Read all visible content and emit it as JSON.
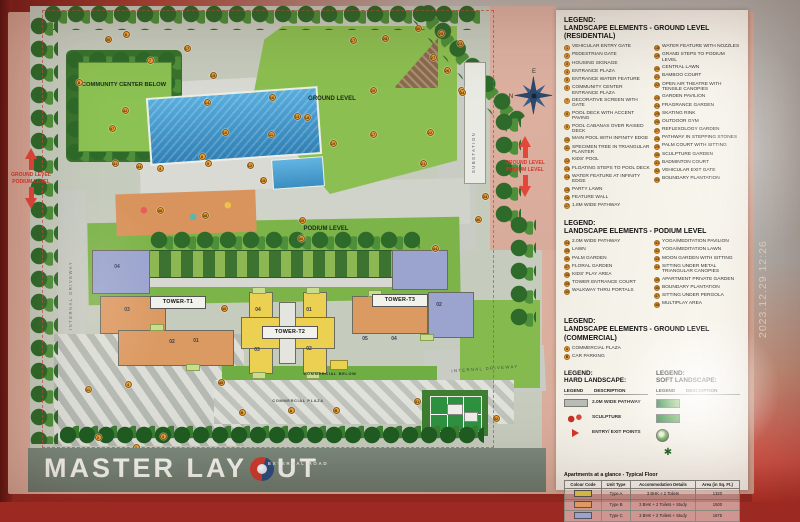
{
  "photo": {
    "timestamp": "2023.12.29 12:26"
  },
  "band": {
    "part1": "MASTER LAY",
    "part2": "UT",
    "full_title": "MASTER LAYOUT"
  },
  "map": {
    "labels": {
      "community_center": "COMMUNITY CENTER BELOW",
      "ground_level": "GROUND LEVEL",
      "podium_level": "PODIUM LEVEL",
      "commercial_below": "COMMERCIAL BELOW",
      "commercial_plaza": "COMMERCIAL PLAZA",
      "internal_driveway_left": "INTERNAL DRIVEWAY",
      "internal_driveway_right": "INTERNAL DRIVEWAY",
      "substation": "SUBSTATION",
      "external_road": "EXTERNAL ROAD"
    },
    "towers": [
      {
        "label": "TOWER-T1"
      },
      {
        "label": "TOWER-T2"
      },
      {
        "label": "TOWER-T3"
      }
    ],
    "level_indicator": {
      "line1": "GROUND LEVEL",
      "line2": "PODIUM LEVEL"
    },
    "compass": {
      "top": "E",
      "right": "S",
      "bottom": "W",
      "left": "N"
    },
    "unit_labels": [
      {
        "t": "04",
        "x": 117,
        "y": 268
      },
      {
        "t": "03",
        "x": 127,
        "y": 311
      },
      {
        "t": "02",
        "x": 172,
        "y": 343
      },
      {
        "t": "01",
        "x": 196,
        "y": 342
      },
      {
        "t": "04",
        "x": 258,
        "y": 311
      },
      {
        "t": "01",
        "x": 309,
        "y": 311
      },
      {
        "t": "03",
        "x": 257,
        "y": 351
      },
      {
        "t": "02",
        "x": 309,
        "y": 350
      },
      {
        "t": "05",
        "x": 365,
        "y": 340
      },
      {
        "t": "04",
        "x": 394,
        "y": 340
      },
      {
        "t": "02",
        "x": 439,
        "y": 306
      }
    ],
    "markers": [
      {
        "n": "1",
        "x": 136,
        "y": 447
      },
      {
        "n": "2",
        "x": 98,
        "y": 437
      },
      {
        "n": "3",
        "x": 163,
        "y": 436
      },
      {
        "n": "4",
        "x": 128,
        "y": 384
      },
      {
        "n": "4",
        "x": 160,
        "y": 168
      },
      {
        "n": "6",
        "x": 126,
        "y": 34
      },
      {
        "n": "7",
        "x": 150,
        "y": 60
      },
      {
        "n": "8",
        "x": 79,
        "y": 82
      },
      {
        "n": "8",
        "x": 202,
        "y": 156
      },
      {
        "n": "9",
        "x": 208,
        "y": 163
      },
      {
        "n": "10",
        "x": 225,
        "y": 132
      },
      {
        "n": "11",
        "x": 271,
        "y": 134
      },
      {
        "n": "11",
        "x": 88,
        "y": 389
      },
      {
        "n": "12",
        "x": 250,
        "y": 165
      },
      {
        "n": "13",
        "x": 297,
        "y": 116
      },
      {
        "n": "14",
        "x": 207,
        "y": 102
      },
      {
        "n": "15",
        "x": 213,
        "y": 75
      },
      {
        "n": "15",
        "x": 263,
        "y": 180
      },
      {
        "n": "16",
        "x": 272,
        "y": 97
      },
      {
        "n": "17",
        "x": 187,
        "y": 48
      },
      {
        "n": "17",
        "x": 353,
        "y": 40
      },
      {
        "n": "17",
        "x": 373,
        "y": 134
      },
      {
        "n": "18",
        "x": 307,
        "y": 117
      },
      {
        "n": "19",
        "x": 333,
        "y": 143
      },
      {
        "n": "20",
        "x": 373,
        "y": 90
      },
      {
        "n": "21",
        "x": 423,
        "y": 163
      },
      {
        "n": "22",
        "x": 430,
        "y": 132
      },
      {
        "n": "23",
        "x": 460,
        "y": 43
      },
      {
        "n": "24",
        "x": 461,
        "y": 90
      },
      {
        "n": "25",
        "x": 441,
        "y": 33
      },
      {
        "n": "26",
        "x": 447,
        "y": 70
      },
      {
        "n": "27",
        "x": 433,
        "y": 57
      },
      {
        "n": "28",
        "x": 385,
        "y": 38
      },
      {
        "n": "30",
        "x": 108,
        "y": 39
      },
      {
        "n": "30",
        "x": 418,
        "y": 28
      },
      {
        "n": "31",
        "x": 417,
        "y": 401
      },
      {
        "n": "32",
        "x": 496,
        "y": 418
      },
      {
        "n": "33",
        "x": 485,
        "y": 196
      },
      {
        "n": "34",
        "x": 462,
        "y": 92
      },
      {
        "n": "35",
        "x": 302,
        "y": 220
      },
      {
        "n": "36",
        "x": 301,
        "y": 238
      },
      {
        "n": "38",
        "x": 205,
        "y": 215
      },
      {
        "n": "40",
        "x": 224,
        "y": 308
      },
      {
        "n": "41",
        "x": 115,
        "y": 163
      },
      {
        "n": "42",
        "x": 125,
        "y": 110
      },
      {
        "n": "44",
        "x": 139,
        "y": 166
      },
      {
        "n": "44",
        "x": 435,
        "y": 248
      },
      {
        "n": "45",
        "x": 221,
        "y": 382
      },
      {
        "n": "46",
        "x": 478,
        "y": 219
      },
      {
        "n": "47",
        "x": 112,
        "y": 128
      },
      {
        "n": "48",
        "x": 160,
        "y": 210
      },
      {
        "n": "A",
        "x": 291,
        "y": 410
      },
      {
        "n": "B",
        "x": 242,
        "y": 412
      },
      {
        "n": "B",
        "x": 336,
        "y": 410
      }
    ]
  },
  "legend": {
    "residential": {
      "heading_label": "LEGEND:",
      "title": "LANDSCAPE ELEMENTS - GROUND LEVEL",
      "subtitle": "(RESIDENTIAL)",
      "items": [
        {
          "n": "1",
          "label": "VEHICULAR ENTRY GATE"
        },
        {
          "n": "2",
          "label": "PEDESTRIAN GATE"
        },
        {
          "n": "3",
          "label": "HOUSING SIGNAGE"
        },
        {
          "n": "4",
          "label": "ENTRANCE PLAZA"
        },
        {
          "n": "5",
          "label": "ENTRANCE WATER FEATURE"
        },
        {
          "n": "6",
          "label": "COMMUNITY CENTER ENTRANCE PLAZA"
        },
        {
          "n": "7",
          "label": "DECORATIVE SCREEN WITH GATE"
        },
        {
          "n": "8",
          "label": "POOL DECK WITH ACCENT PAVING"
        },
        {
          "n": "9",
          "label": "POOL CABANAS OVER RAISED DECK"
        },
        {
          "n": "10",
          "label": "MAIN POOL WITH INFINITY EDGE"
        },
        {
          "n": "11",
          "label": "SPECIMEN TREE IN TRIANGULAR PLANTER"
        },
        {
          "n": "12",
          "label": "KIDS' POOL"
        },
        {
          "n": "13",
          "label": "FLOATING STEPS TO POOL DECK"
        },
        {
          "n": "14",
          "label": "WATER FEATURE AT INFINITY EDGE"
        },
        {
          "n": "15",
          "label": "PARTY LAWN"
        },
        {
          "n": "16",
          "label": "FEATURE WALL"
        },
        {
          "n": "17",
          "label": "1.8M WIDE PATHWAY"
        },
        {
          "n": "18",
          "label": "WATER FEATURE WITH NOZZLES"
        },
        {
          "n": "19",
          "label": "GRAND STEPS TO PODIUM LEVEL"
        },
        {
          "n": "20",
          "label": "CENTRAL LAWN"
        },
        {
          "n": "21",
          "label": "BAMBOO COURT"
        },
        {
          "n": "22",
          "label": "OPEN AIR THEATRE WITH TENSILE CANOPIES"
        },
        {
          "n": "23",
          "label": "GARDEN PAVILION"
        },
        {
          "n": "24",
          "label": "FRAGRANCE GARDEN"
        },
        {
          "n": "25",
          "label": "SKATING RINK"
        },
        {
          "n": "26",
          "label": "OUTDOOR GYM"
        },
        {
          "n": "27",
          "label": "REFLEXOLOGY GARDEN"
        },
        {
          "n": "28",
          "label": "PATHWAY IN STEPPING STONES"
        },
        {
          "n": "29",
          "label": "PALM COURT WITH SITTING"
        },
        {
          "n": "30",
          "label": "SCULPTURE GARDEN"
        },
        {
          "n": "31",
          "label": "BADMINTON COURT"
        },
        {
          "n": "32",
          "label": "VEHICULAR EXIT GATE"
        },
        {
          "n": "33",
          "label": "BOUNDARY PLANTATION"
        }
      ]
    },
    "podium": {
      "heading_label": "LEGEND:",
      "title": "LANDSCAPE ELEMENTS - PODIUM LEVEL",
      "items": [
        {
          "n": "34",
          "label": "2.0M WIDE PATHWAY"
        },
        {
          "n": "35",
          "label": "LAWN"
        },
        {
          "n": "36",
          "label": "PALM GARDEN"
        },
        {
          "n": "37",
          "label": "FLORAL GARDEN"
        },
        {
          "n": "38",
          "label": "KIDS' PLAY AREA"
        },
        {
          "n": "39",
          "label": "TOWER ENTRANCE COURT"
        },
        {
          "n": "40",
          "label": "WALKWAY THRU PORTALS"
        },
        {
          "n": "41",
          "label": "YOGA/MEDITATION PAVILION"
        },
        {
          "n": "42",
          "label": "YOGA/MEDITATION LAWN"
        },
        {
          "n": "43",
          "label": "MOON GARDEN WITH SITTING"
        },
        {
          "n": "44",
          "label": "SITTING UNDER METAL TRIANGULAR CANOPIES"
        },
        {
          "n": "45",
          "label": "APARTMENT PRIVATE GARDEN"
        },
        {
          "n": "46",
          "label": "BOUNDARY PLANTATION"
        },
        {
          "n": "47",
          "label": "SITTING UNDER PERGOLA"
        },
        {
          "n": "48",
          "label": "MULTIPLAY AREA"
        }
      ]
    },
    "commercial": {
      "heading_label": "LEGEND:",
      "title": "LANDSCAPE ELEMENTS - GROUND LEVEL",
      "subtitle": "(COMMERCIAL)",
      "items": [
        {
          "n": "A",
          "label": "COMMERCIAL PLAZA"
        },
        {
          "n": "B",
          "label": "CAR PARKING"
        }
      ]
    },
    "hard": {
      "heading_label": "LEGEND:",
      "title": "HARD LANDSCAPE:",
      "col_legend": "LEGEND",
      "col_desc": "DESCRIPTION",
      "rows": [
        {
          "icon": "path-swatch",
          "label": "2.0M WIDE PATHWAY"
        },
        {
          "icon": "sculpture",
          "label": "SCULPTURE"
        },
        {
          "icon": "entry-arrow",
          "label": "ENTRY/ EXIT POINTS"
        }
      ]
    },
    "soft": {
      "heading_label": "LEGEND:",
      "title": "SOFT LANDSCAPE:",
      "col_legend": "LEGEND",
      "col_desc": "DESCRIPTION",
      "rows": [
        {
          "icon": "lawn-swatch",
          "label": ""
        },
        {
          "icon": "shrub-swatch",
          "label": ""
        },
        {
          "icon": "tree",
          "label": ""
        },
        {
          "icon": "palm",
          "label": ""
        }
      ]
    },
    "apartments": {
      "title": "Apartments at a glance - Typical Floor",
      "columns": [
        "Colour Code",
        "Unit Type",
        "Accommodation Details",
        "Area (in Sq. Ft.)"
      ],
      "rows": [
        {
          "color": "#eccf4e",
          "unit": "Type A",
          "details": "3 BHK + 2 Toilets",
          "area": "1320"
        },
        {
          "color": "#dd9a62",
          "unit": "Type B",
          "details": "3 BHK + 2 Toilets + Study",
          "area": "1500"
        },
        {
          "color": "#9aa3d0",
          "unit": "Type C",
          "details": "3 BHK + 2 Toilets + Study",
          "area": "1675"
        }
      ]
    }
  }
}
